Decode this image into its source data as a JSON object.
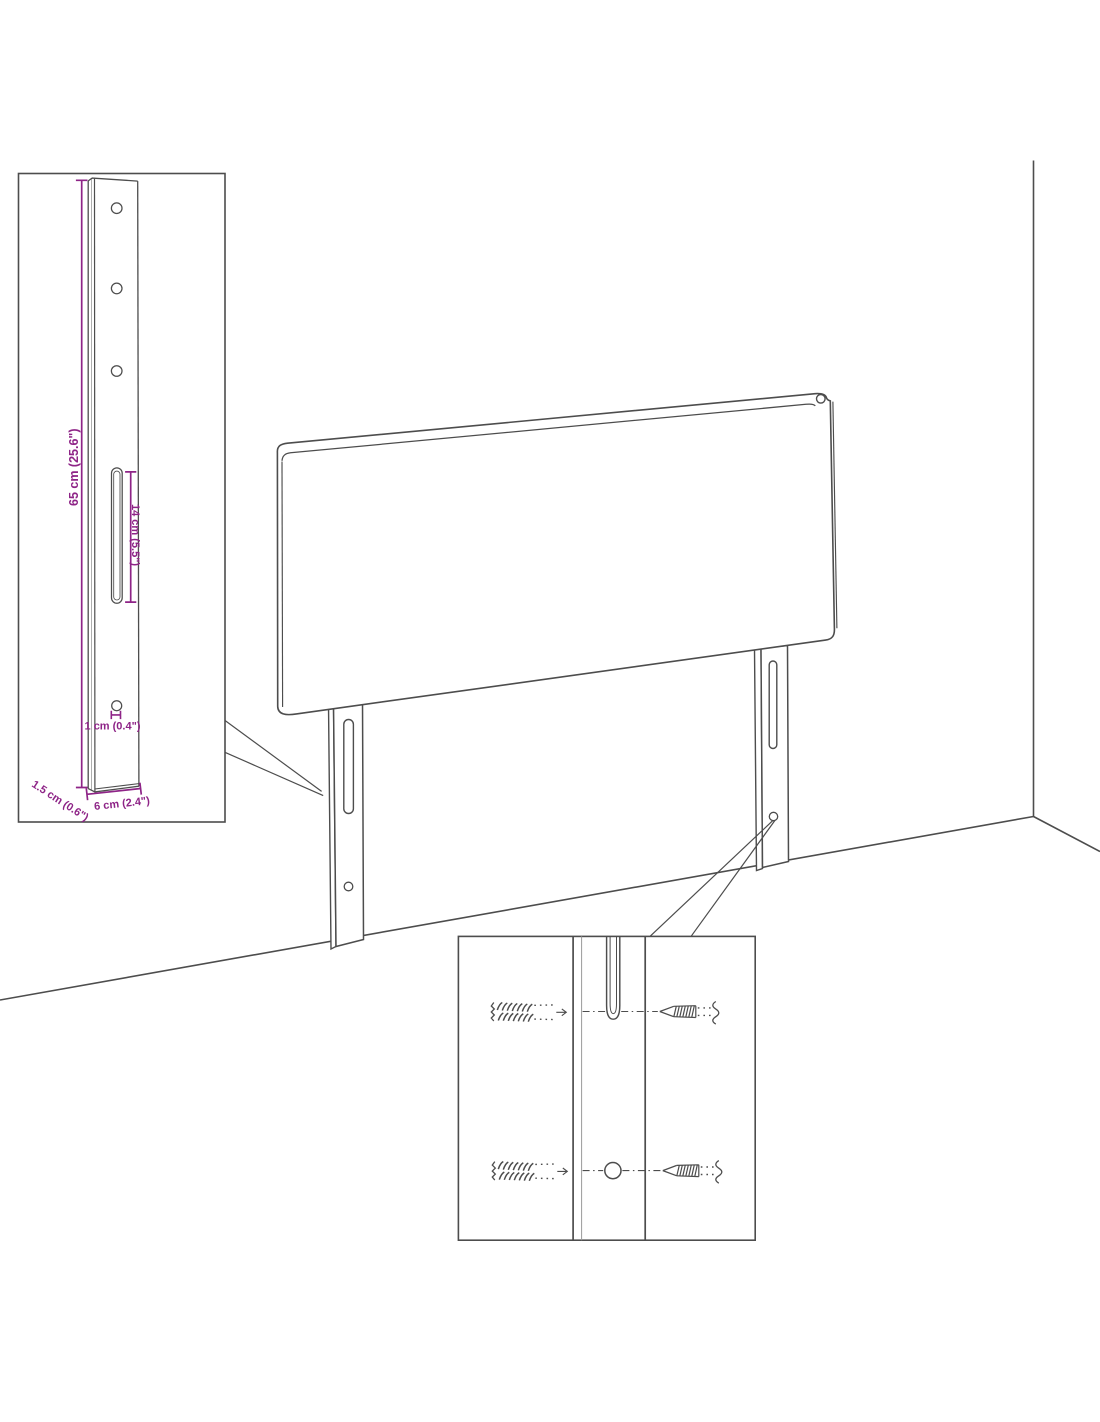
{
  "diagram": {
    "subject": "headboard with mounting legs in room corner",
    "background": "#ffffff",
    "line_color": "#4d4d4d",
    "dimension_color": "#8e2487"
  },
  "dimensions": {
    "total_height": "65 cm (25.6\")",
    "slot_length": "14 cm (5.5\")",
    "hole_diameter": "1 cm (0.4\")",
    "thickness": "1.5 cm (0.6\")",
    "width": "6 cm (2.4\")"
  },
  "icons": {
    "wall_plug": "wall-plug-icon",
    "screw": "screw-icon"
  }
}
